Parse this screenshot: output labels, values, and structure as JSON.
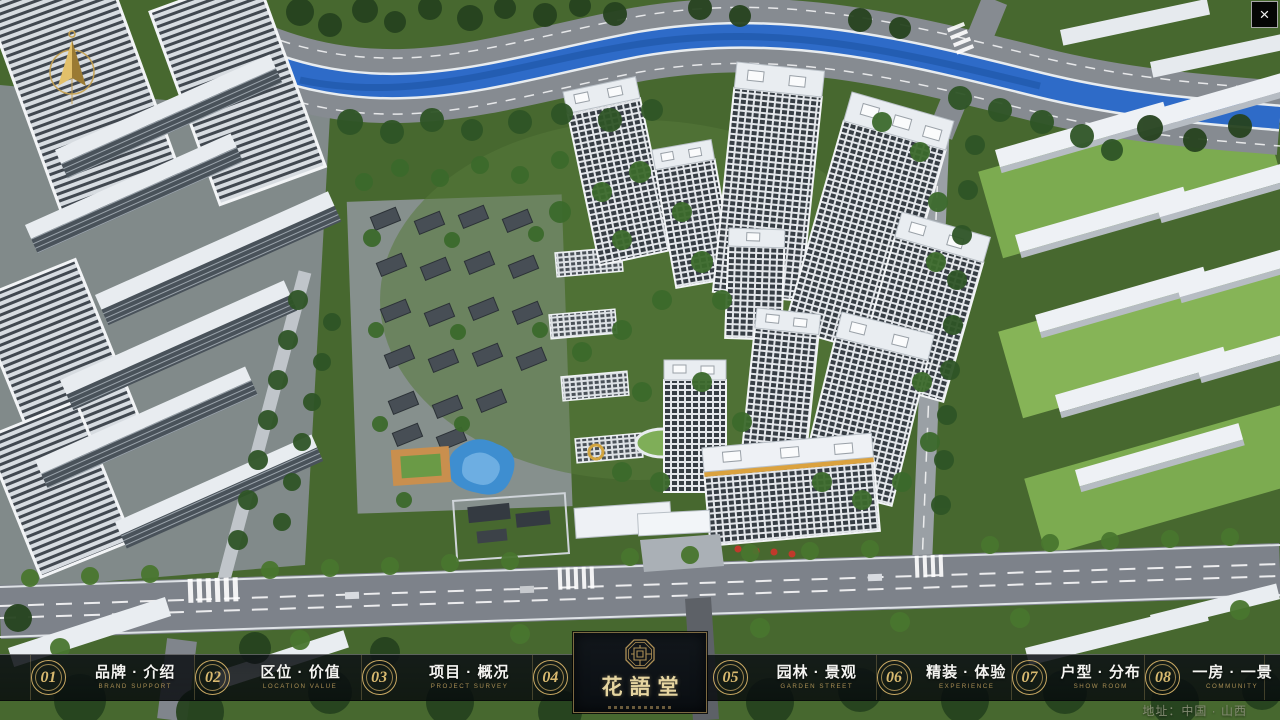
{
  "window": {
    "close": "×"
  },
  "nav": {
    "items": [
      {
        "num": "01",
        "label": "品牌 · 介绍",
        "sub": "BRAND SUPPORT"
      },
      {
        "num": "02",
        "label": "区位 · 价值",
        "sub": "LOCATION VALUE"
      },
      {
        "num": "03",
        "label": "项目 · 概况",
        "sub": "PROJECT SURVEY"
      },
      {
        "num": "04",
        "label": "建筑 · 鉴赏",
        "sub": "APPRECIATION"
      },
      {
        "num": "05",
        "label": "园林 · 景观",
        "sub": "GARDEN STREET"
      },
      {
        "num": "06",
        "label": "精装 · 体验",
        "sub": "EXPERIENCE"
      },
      {
        "num": "07",
        "label": "户型 · 分布",
        "sub": "SHOW ROOM"
      },
      {
        "num": "08",
        "label": "一房 · 一景",
        "sub": "COMMUNITY"
      }
    ]
  },
  "logo": {
    "title": "花語堂"
  },
  "footer": {
    "address": "地址：中国 · 山西"
  },
  "colors": {
    "gold": "#c9a963",
    "river": "#2e6bc8",
    "bar_bg": "rgba(8,12,16,0.8)"
  }
}
